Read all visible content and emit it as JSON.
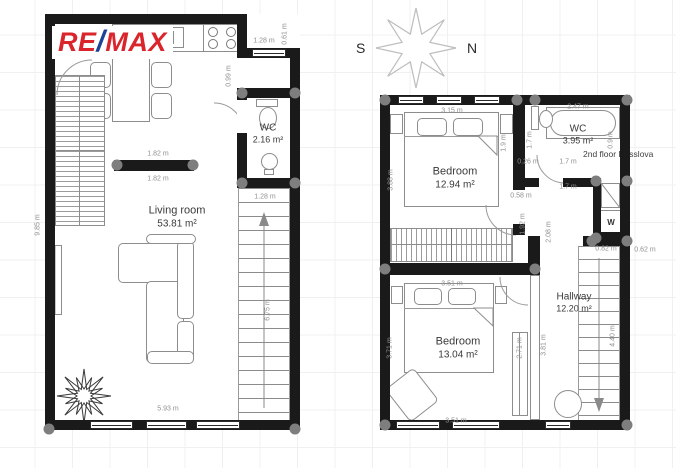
{
  "brand": {
    "re": "RE",
    "slash": "/",
    "max": "MAX"
  },
  "compass": {
    "west": "S",
    "east": "N"
  },
  "floor_note": "2nd floor Resslova",
  "labels": {
    "washer": "W"
  },
  "rooms": {
    "living_room": {
      "name": "Living room",
      "area": "53.81 m²"
    },
    "wc1": {
      "name": "WC",
      "area": "2.16 m²"
    },
    "bedroom1": {
      "name": "Bedroom",
      "area": "12.94 m²"
    },
    "wc2": {
      "name": "WC",
      "area": "3.95 m²"
    },
    "bedroom2": {
      "name": "Bedroom",
      "area": "13.04 m²"
    },
    "hallway": {
      "name": "Hallway",
      "area": "12.20 m²"
    }
  },
  "dimensions": [
    {
      "text": "1.28 m",
      "x": 264,
      "y": 41,
      "rot": 0
    },
    {
      "text": "0.61 m",
      "x": 285,
      "y": 34,
      "rot": 90
    },
    {
      "text": "0.99 m",
      "x": 229,
      "y": 76,
      "rot": 90
    },
    {
      "text": "1.82 m",
      "x": 158,
      "y": 154,
      "rot": 0
    },
    {
      "text": "1.82 m",
      "x": 158,
      "y": 179,
      "rot": 0
    },
    {
      "text": "9.85 m",
      "x": 38,
      "y": 225,
      "rot": 90
    },
    {
      "text": "1.28 m",
      "x": 265,
      "y": 197,
      "rot": 0
    },
    {
      "text": "6.75 m",
      "x": 268,
      "y": 310,
      "rot": 90
    },
    {
      "text": "5.93 m",
      "x": 168,
      "y": 409,
      "rot": 0
    },
    {
      "text": "3.15 m",
      "x": 452,
      "y": 111,
      "rot": 0
    },
    {
      "text": "2.47 m",
      "x": 578,
      "y": 107,
      "rot": 0
    },
    {
      "text": "3.88 m",
      "x": 391,
      "y": 180,
      "rot": 90
    },
    {
      "text": "1.9 m",
      "x": 504,
      "y": 143,
      "rot": 90
    },
    {
      "text": "1.7 m",
      "x": 530,
      "y": 140,
      "rot": 90
    },
    {
      "text": "0.26 m",
      "x": 528,
      "y": 162,
      "rot": 0
    },
    {
      "text": "1.7 m",
      "x": 568,
      "y": 162,
      "rot": 0
    },
    {
      "text": "1.7 m",
      "x": 568,
      "y": 187,
      "rot": 0
    },
    {
      "text": "0.9 m",
      "x": 611,
      "y": 140,
      "rot": 90
    },
    {
      "text": "0.58 m",
      "x": 521,
      "y": 196,
      "rot": 0
    },
    {
      "text": "1.92 m",
      "x": 523,
      "y": 224,
      "rot": 90
    },
    {
      "text": "2.08 m",
      "x": 549,
      "y": 232,
      "rot": 90
    },
    {
      "text": "0.82 m",
      "x": 606,
      "y": 249,
      "rot": 0
    },
    {
      "text": "0.62 m",
      "x": 645,
      "y": 250,
      "rot": 0
    },
    {
      "text": "3.51 m",
      "x": 452,
      "y": 284,
      "rot": 0
    },
    {
      "text": "3.71 m",
      "x": 390,
      "y": 348,
      "rot": 90
    },
    {
      "text": "2.71 m",
      "x": 520,
      "y": 348,
      "rot": 90
    },
    {
      "text": "3.81 m",
      "x": 544,
      "y": 345,
      "rot": 90
    },
    {
      "text": "4.40 m",
      "x": 613,
      "y": 336,
      "rot": 90
    },
    {
      "text": "3.51 m",
      "x": 456,
      "y": 421,
      "rot": 0
    }
  ],
  "colors": {
    "brand_red": "#d9252b",
    "brand_blue": "#1d4296",
    "wall": "#1a1a1a",
    "junction_dot": "#7e7e7e",
    "dimension_text": "#8f8f8f",
    "compass_outline": "#bdbdbd"
  }
}
